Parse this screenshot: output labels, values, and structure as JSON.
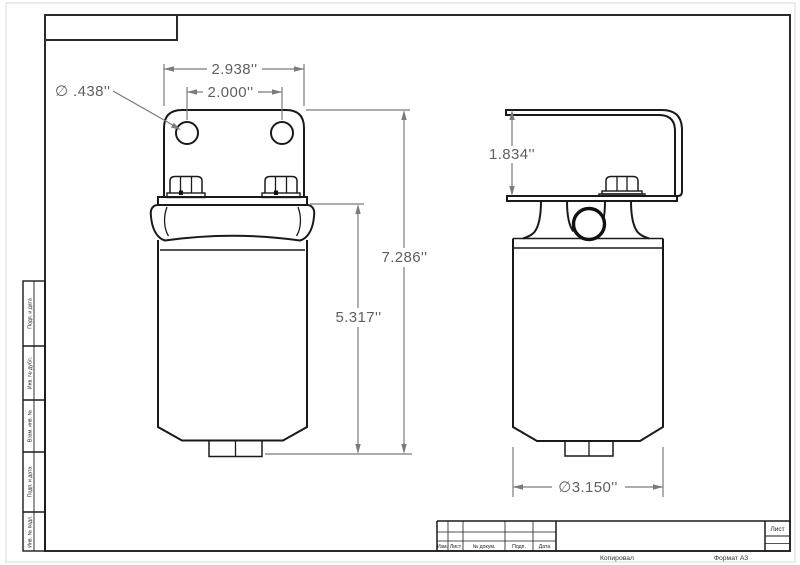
{
  "drawing": {
    "dims": {
      "bracket_width": "2.938''",
      "hole_spacing": "2.000''",
      "hole_diameter": "∅ .438''",
      "overall_height": "7.286''",
      "body_height": "5.317''",
      "bracket_height": "1.834''",
      "body_diameter": "∅3.150''"
    }
  },
  "left_column": {
    "labels": [
      "Подп. и дата",
      "Инв. № дубл.",
      "Взам. инв. №",
      "Подп. и дата",
      "Инв. № подл."
    ]
  },
  "title_block": {
    "headers": [
      "Изм.",
      "Лист",
      "№ докум.",
      "Подп.",
      "Дата"
    ],
    "sheet_label": "Лист"
  },
  "footer": {
    "copied": "Копировал",
    "format": "Формат А3"
  }
}
